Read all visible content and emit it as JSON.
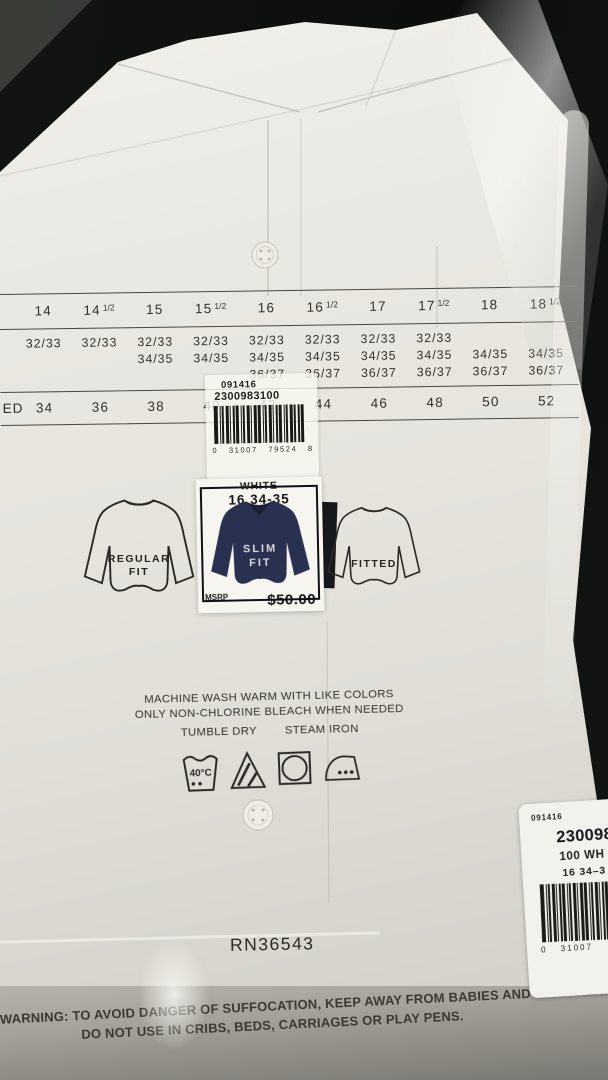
{
  "size_chart": {
    "neck": [
      "14",
      "14½",
      "15",
      "15½",
      "16",
      "16½",
      "17",
      "17½",
      "18",
      "18½"
    ],
    "sleeves": [
      [
        "32/33",
        "",
        ""
      ],
      [
        "32/33",
        "",
        ""
      ],
      [
        "32/33",
        "34/35",
        ""
      ],
      [
        "32/33",
        "34/35",
        ""
      ],
      [
        "32/33",
        "34/35",
        "36/37"
      ],
      [
        "32/33",
        "34/35",
        "36/37"
      ],
      [
        "32/33",
        "34/35",
        "36/37"
      ],
      [
        "32/33",
        "34/35",
        "36/37"
      ],
      [
        "",
        "34/35",
        "36/37"
      ],
      [
        "",
        "34/35",
        "36/37"
      ]
    ],
    "row_label_partial": "ED",
    "chest": [
      "34",
      "36",
      "38",
      "40",
      "42",
      "44",
      "46",
      "48",
      "50",
      "52"
    ]
  },
  "price_sticker": {
    "style_code": "091416",
    "sku": "2300983100",
    "upc": "0 31007 79524 8"
  },
  "fit_label": {
    "color": "WHITE",
    "size": "16 34-35",
    "fit_line1": "SLIM",
    "fit_line2": "FIT",
    "msrp_label": "MSRP",
    "price": "$50.00"
  },
  "fit_icons": {
    "left_line1": "REGULAR",
    "left_line2": "FIT",
    "right": "FITTED"
  },
  "care": {
    "line1": "MACHINE WASH WARM WITH LIKE COLORS",
    "line2": "ONLY NON-CHLORINE BLEACH WHEN NEEDED",
    "tumble": "TUMBLE DRY",
    "iron": "STEAM IRON",
    "wash_temp": "40°C"
  },
  "rn": "RN36543",
  "side_sticker": {
    "style_code": "091416",
    "sku_partial": "2300983",
    "color_partial": "100 WH",
    "size_partial": "16 34–3",
    "upc_partial": "0 31007"
  },
  "bag_warning": {
    "line1": "WARNING: TO AVOID DANGER OF SUFFOCATION, KEEP AWAY FROM BABIES AND CHILDREN.",
    "line2": "DO NOT USE IN CRIBS, BEDS, CARRIAGES OR PLAY PENS."
  },
  "colors": {
    "background": "#0e100e",
    "package_white": "#e9e7e1",
    "ink": "#2d2b27",
    "label_navy": "#2a3150"
  }
}
